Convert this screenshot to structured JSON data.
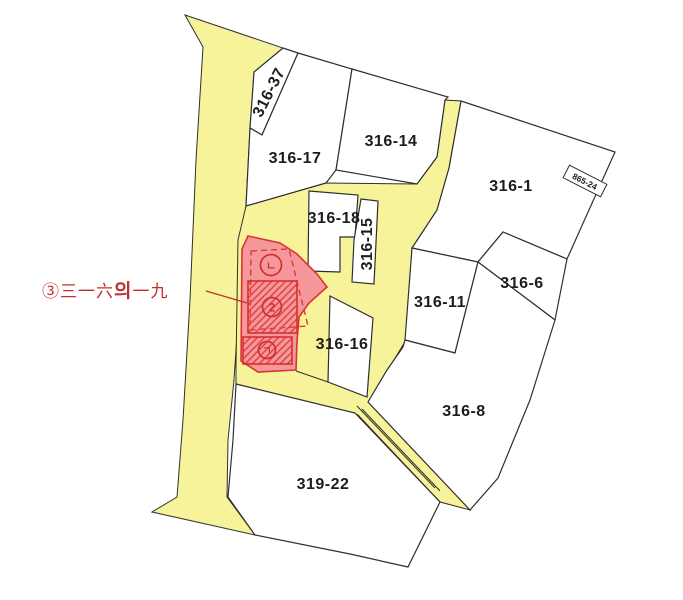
{
  "map": {
    "kind": "cadastral parcel map",
    "colors": {
      "road_fill": "#f7f39b",
      "parcel_fill": "#ffffff",
      "boundary": "#2f2f2f",
      "highlight_fill": "#f4989b",
      "highlight_stroke": "#d93333",
      "annotation": "#c03030"
    },
    "parcels": [
      {
        "label": "316-37"
      },
      {
        "label": "316-17"
      },
      {
        "label": "316-14"
      },
      {
        "label": "316-18"
      },
      {
        "label": "316-15"
      },
      {
        "label": "316-1"
      },
      {
        "label": "316-6"
      },
      {
        "label": "316-11"
      },
      {
        "label": "316-16"
      },
      {
        "label": "316-8"
      },
      {
        "label": "319-22"
      }
    ],
    "edge_label": {
      "label": "865-24"
    },
    "highlight": {
      "callout": {
        "circled_index": "③",
        "text_before": "三一六",
        "text_emphasis": "의",
        "text_after": "一九"
      },
      "markers": {
        "top": "ㄴ",
        "center": "2",
        "bottom": "ㄱ"
      }
    }
  }
}
